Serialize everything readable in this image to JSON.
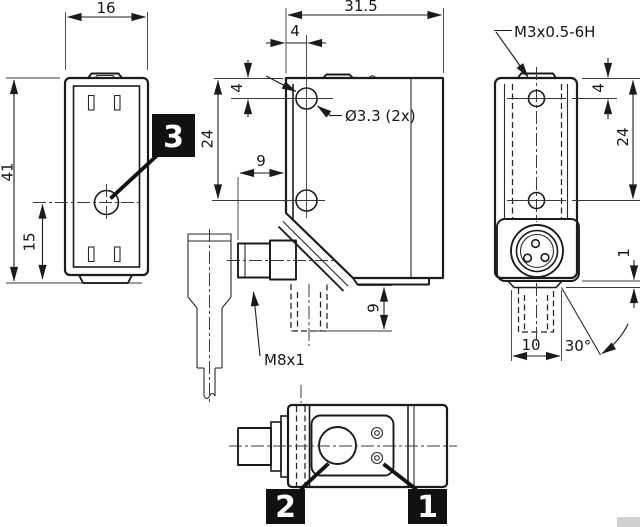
{
  "views": {
    "front": {
      "dims": {
        "width": "16",
        "height": "41",
        "optical_axis_height": "15"
      },
      "callout": "3"
    },
    "side": {
      "dims": {
        "width": "31.5",
        "hole_offset_x": "4",
        "hole_offset_y": "4",
        "hole_spacing": "24",
        "connector_protrusion": "9",
        "connector_down_protrusion": "9"
      },
      "labels": {
        "mounting_holes": "Ø3.3 (2x)",
        "connector_thread": "M8x1"
      }
    },
    "rear": {
      "dims": {
        "hole_offset_y": "4",
        "hole_spacing": "24",
        "housing_step": "1",
        "connector_width": "10",
        "swivel_angle": "30°"
      },
      "labels": {
        "mounting_thread": "M3x0.5-6H"
      }
    },
    "bottom": {
      "callout_lens": "2",
      "callout_indicator": "1"
    }
  }
}
